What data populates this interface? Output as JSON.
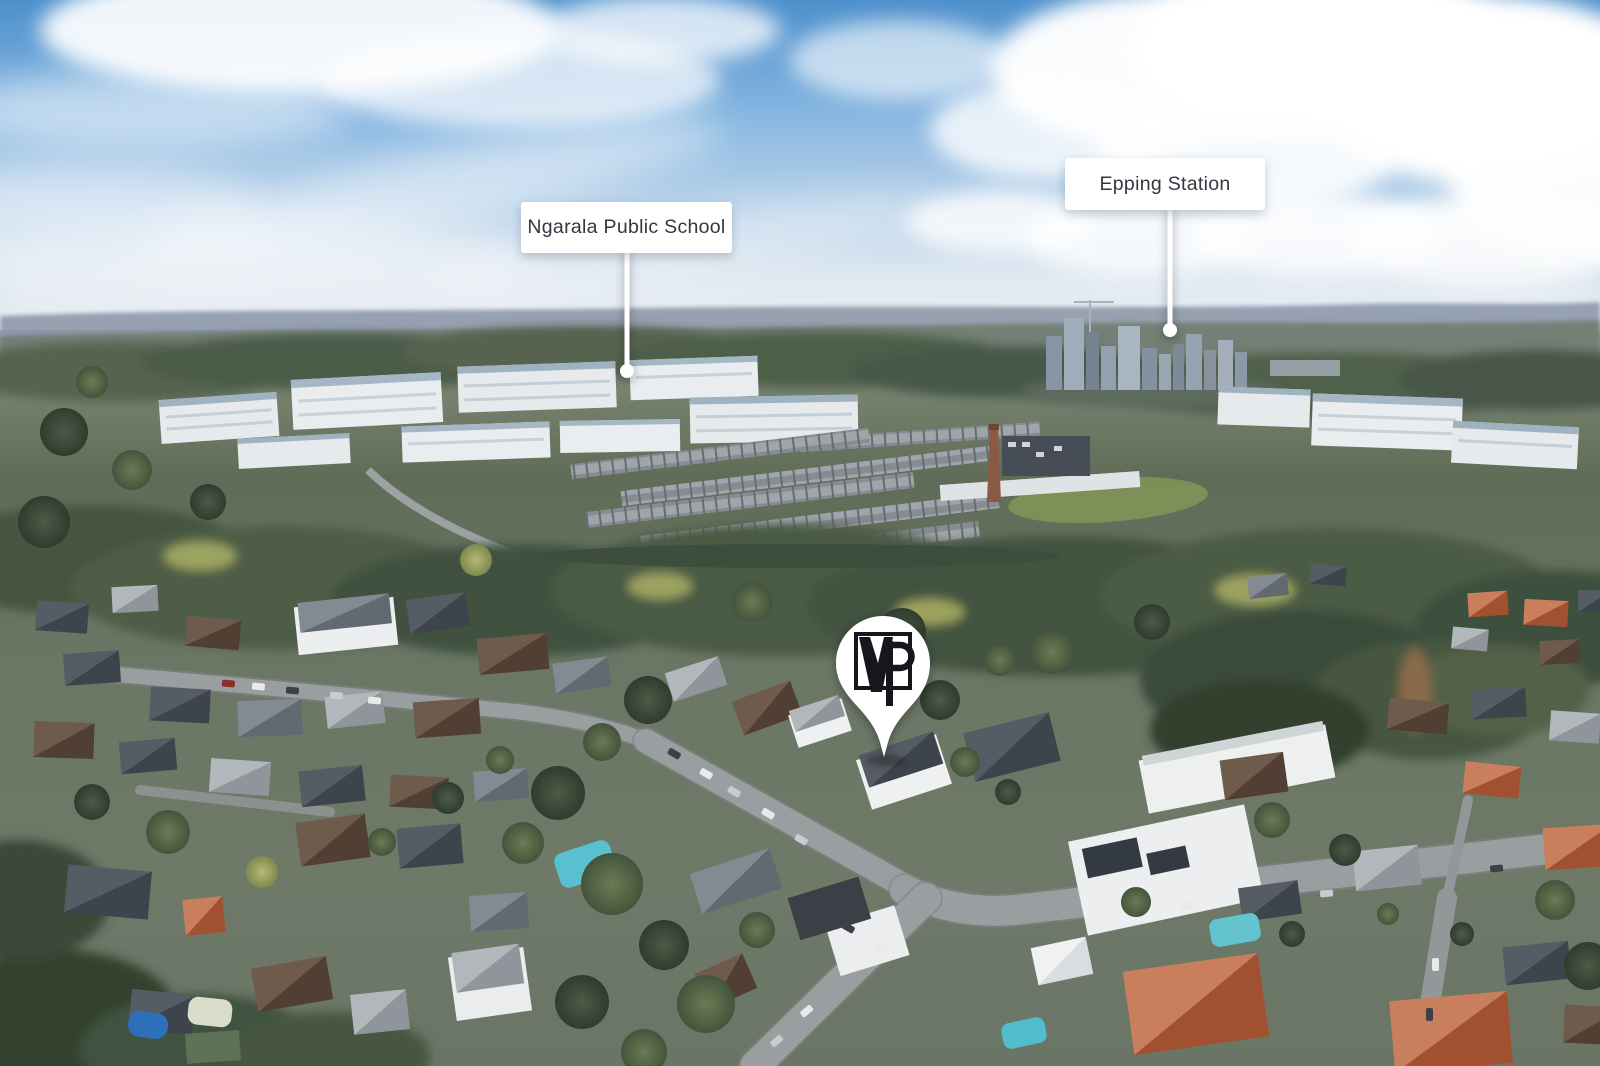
{
  "annotations": {
    "school_label": {
      "text": "Ngarala Public School"
    },
    "station_label": {
      "text": "Epping Station"
    },
    "pin": {
      "logo_text": "VP"
    }
  },
  "colors": {
    "label_background": "#ffffff",
    "label_text": "#343640",
    "leader_line": "#ffffff",
    "pin_fill": "#ffffff",
    "pin_logo": "#17181a",
    "sky_top": "#4e90cc",
    "sky_horizon": "#e3e9ef"
  }
}
